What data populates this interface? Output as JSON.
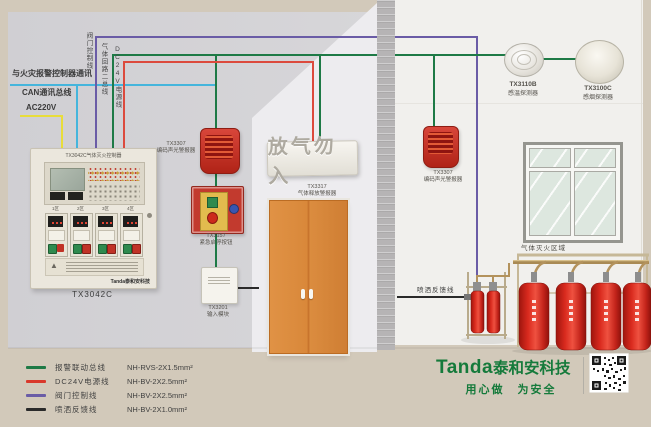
{
  "wire_labels": {
    "comm": "与火灾报警控制器通讯",
    "can_bus": "CAN通讯总线",
    "ac_power": "AC220V",
    "valve_control": "阀门控制线",
    "gas_loop_bus": "气体回路二总线",
    "dc24v_power": "DC24V电源线",
    "spray_feedback": "喷洒反馈线"
  },
  "panel": {
    "title": "TX3042C气体灭火控制器",
    "model": "TX3042C",
    "zones": [
      "1区",
      "2区",
      "3区",
      "4区"
    ],
    "brand": "Tanda泰和安科技"
  },
  "devices": {
    "strobe_left": {
      "model": "TX3307",
      "name": "编码声光警报器"
    },
    "estop": {
      "model": "TX3157",
      "name": "紧急启停按钮"
    },
    "input_module": {
      "model": "TX3201",
      "name": "输入模块"
    },
    "release_sign": {
      "text": "放气勿入",
      "model": "TX3317",
      "name": "气体释放警报器"
    },
    "strobe_right": {
      "model": "TX3307",
      "name": "编码声光警报器"
    },
    "heat_detector": {
      "model": "TX3110B",
      "name": "感温探测器"
    },
    "smoke_detector": {
      "model": "TX3100C",
      "name": "感烟探测器"
    }
  },
  "room": {
    "protected_area_label": "气体灭火区域"
  },
  "legend": {
    "items": [
      {
        "name": "报警联动总线",
        "spec": "NH-RVS-2X1.5mm²",
        "color": "#1e7a46"
      },
      {
        "name": "DC24V电源线",
        "spec": "NH-BV-2X2.5mm²",
        "color": "#d9382b"
      },
      {
        "name": "阀门控制线",
        "spec": "NH-BV-2X2.5mm²",
        "color": "#6a5ca6"
      },
      {
        "name": "喷洒反馈线",
        "spec": "NH-BV-2X1.0mm²",
        "color": "#2a2a2a"
      }
    ]
  },
  "footer": {
    "brand_en": "Tanda",
    "brand_cn": "泰和安科技",
    "slogan": "用心做　为安全"
  },
  "colors": {
    "wire_green": "#1e7a46",
    "wire_red": "#dc4a3d",
    "wire_purple": "#6a5ca6",
    "wire_cyan": "#45b5dc",
    "wire_yellow": "#e8dd3a",
    "wire_black": "#2a2a2a",
    "brand_green": "#157a3b"
  }
}
